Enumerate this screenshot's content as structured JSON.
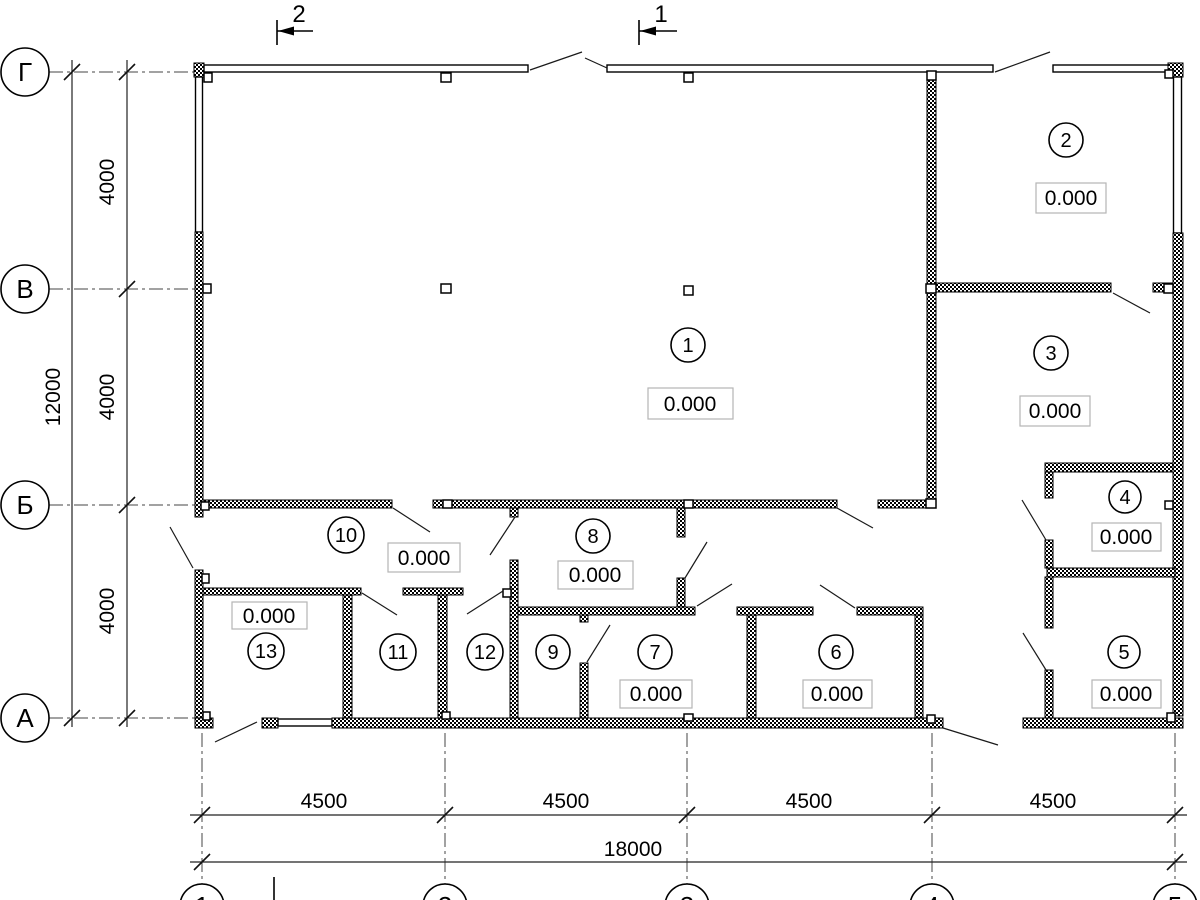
{
  "drawing": {
    "rooms": [
      {
        "number": "1",
        "elevation": "0.000"
      },
      {
        "number": "2",
        "elevation": "0.000"
      },
      {
        "number": "3",
        "elevation": "0.000"
      },
      {
        "number": "4",
        "elevation": "0.000"
      },
      {
        "number": "5",
        "elevation": "0.000"
      },
      {
        "number": "6",
        "elevation": "0.000"
      },
      {
        "number": "7",
        "elevation": "0.000"
      },
      {
        "number": "8",
        "elevation": "0.000"
      },
      {
        "number": "9"
      },
      {
        "number": "10",
        "elevation": "0.000"
      },
      {
        "number": "11"
      },
      {
        "number": "12"
      },
      {
        "number": "13",
        "elevation": "0.000"
      }
    ],
    "axes_left": [
      {
        "label": "Г"
      },
      {
        "label": "В"
      },
      {
        "label": "Б"
      },
      {
        "label": "А"
      }
    ],
    "axes_bottom": [
      {
        "label": "1"
      },
      {
        "label": "2"
      },
      {
        "label": "3"
      },
      {
        "label": "4"
      },
      {
        "label": "5"
      }
    ],
    "sections": [
      {
        "label": "2"
      },
      {
        "label": "1"
      }
    ],
    "dimensions": {
      "bottom_segments": [
        "4500",
        "4500",
        "4500",
        "4500"
      ],
      "bottom_total": "18000",
      "left_segments": [
        "4000",
        "4000",
        "4000"
      ],
      "left_total": "12000"
    }
  }
}
